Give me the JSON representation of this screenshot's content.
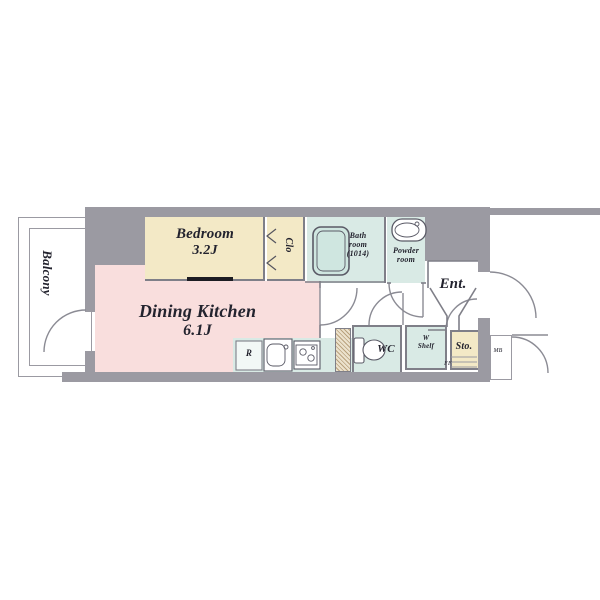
{
  "rooms": {
    "balcony": "Balcony",
    "bedroom_name": "Bedroom",
    "bedroom_size": "3.2J",
    "closet": "Clo",
    "bath_line1": "Bath",
    "bath_line2": "room",
    "bath_line3": "(1014)",
    "powder_line1": "Powder",
    "powder_line2": "room",
    "entrance": "Ent.",
    "dk_name": "Dining Kitchen",
    "dk_size": "6.1J",
    "wc": "WC",
    "shelf_line1": "W",
    "shelf_line2": "Shelf",
    "storage": "Sto.",
    "refrigerator": "R",
    "meter_box": "MB",
    "floor_note": "FF"
  },
  "colors": {
    "wall_gray": "#9b9aa2",
    "room_beige": "#f3e9c6",
    "dk_pink": "#f9dedd",
    "wet_area_blue": "#d9eae5",
    "line_gray": "#7f7f88"
  }
}
